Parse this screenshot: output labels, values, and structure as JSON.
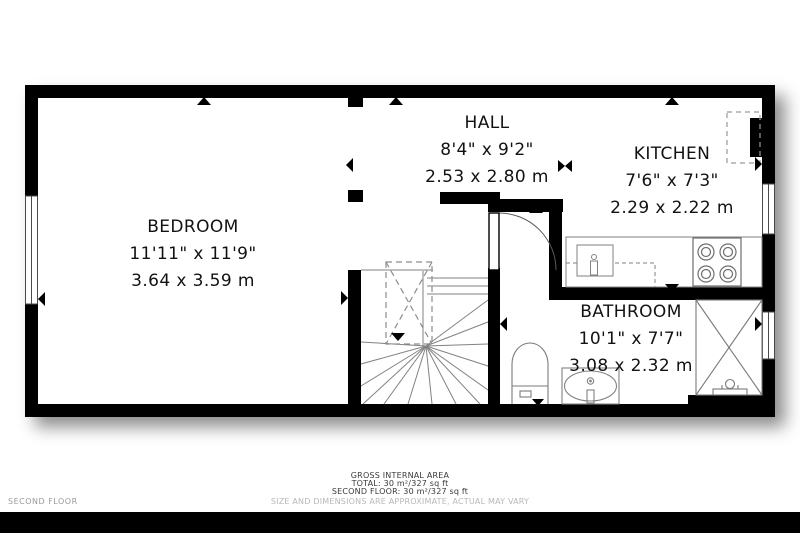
{
  "plan": {
    "floor_label": "SECOND FLOOR",
    "rooms": [
      {
        "name": "BEDROOM",
        "imperial": "11'11\" x 11'9\"",
        "metric": "3.64 x 3.59 m"
      },
      {
        "name": "HALL",
        "imperial": "8'4\" x 9'2\"",
        "metric": "2.53 x 2.80 m"
      },
      {
        "name": "KITCHEN",
        "imperial": "7'6\" x 7'3\"",
        "metric": "2.29 x 2.22 m"
      },
      {
        "name": "BATHROOM",
        "imperial": "10'1\" x 7'7\"",
        "metric": "3.08 x 2.32 m"
      }
    ],
    "fixtures": [
      "staircase",
      "void-hatch",
      "door",
      "kitchen-counter",
      "kitchen-sink",
      "stove-4-burner",
      "refrigerator-dashed",
      "toilet",
      "sink-vanity",
      "shower",
      "window"
    ],
    "colors": {
      "wall": "#000000",
      "fixture_line": "#828282",
      "text": "#121212",
      "muted": "#b8b8b8"
    }
  },
  "footer": {
    "title": "GROSS INTERNAL AREA",
    "total": "TOTAL: 30 m²/327 sq ft",
    "floor_total": "SECOND FLOOR: 30 m²/327 sq ft",
    "disclaimer": "SIZE AND DIMENSIONS ARE APPROXIMATE, ACTUAL MAY VARY"
  }
}
